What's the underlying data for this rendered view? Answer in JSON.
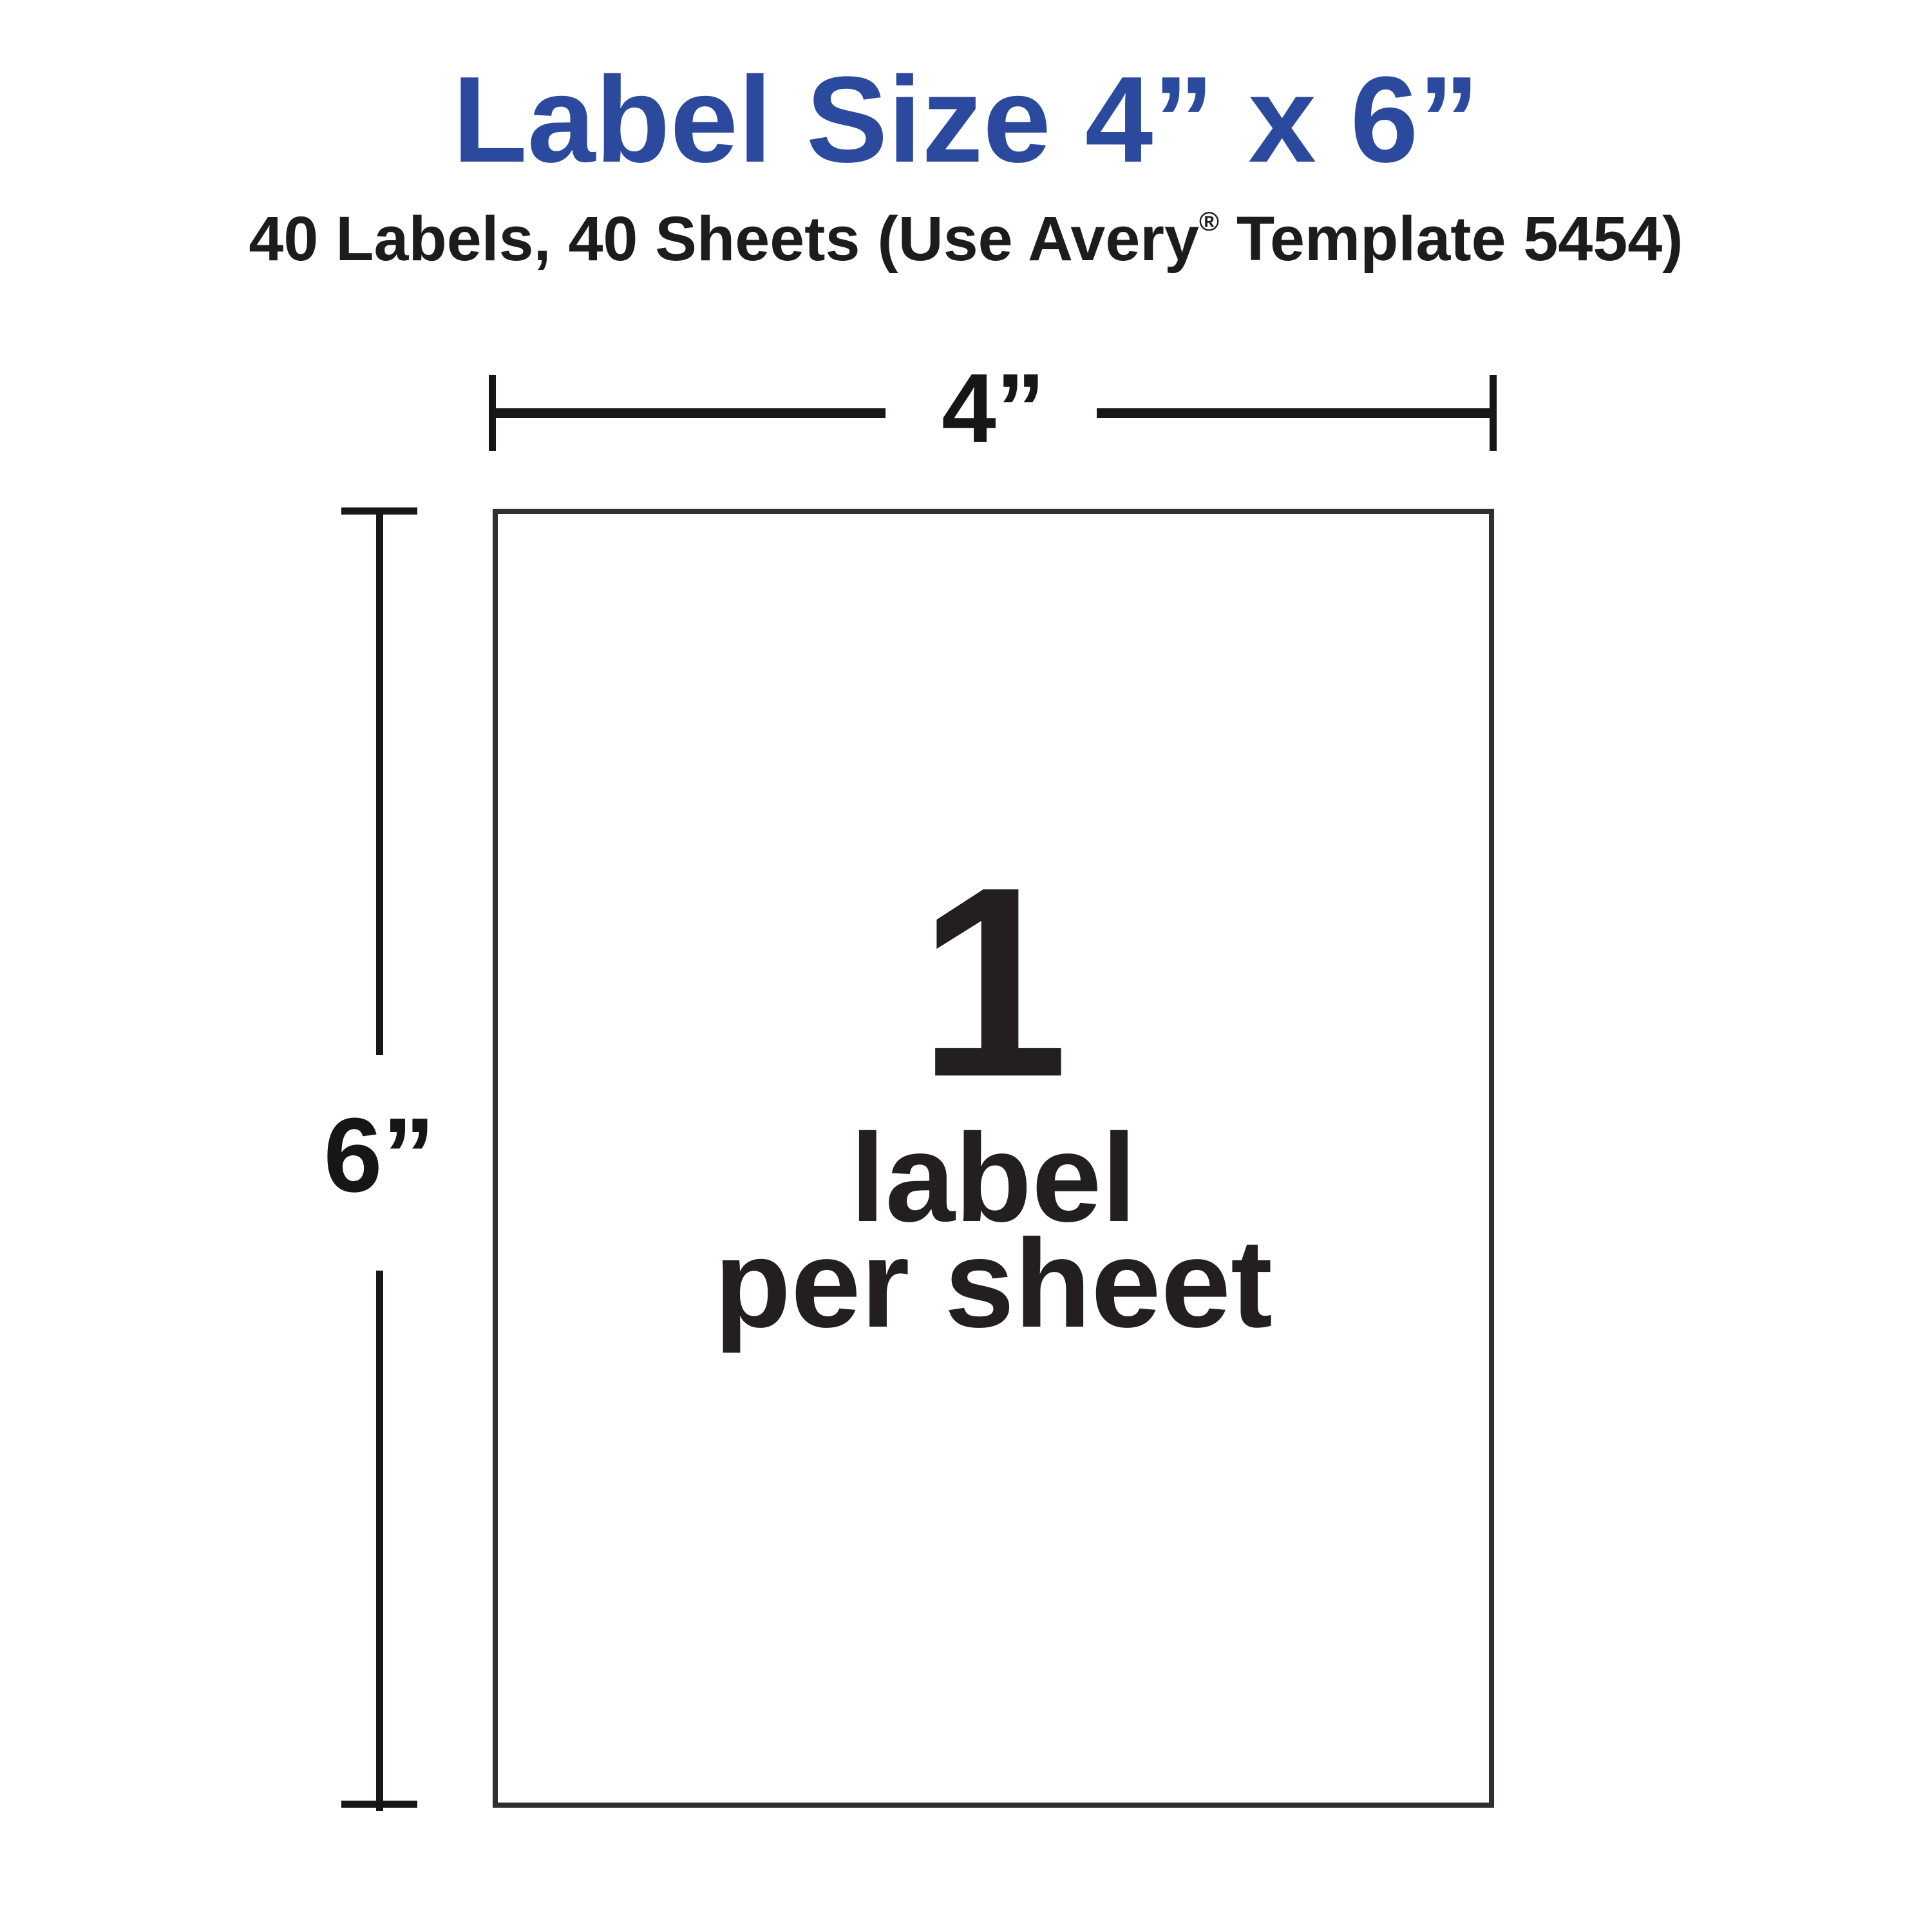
{
  "colors": {
    "background": "#ffffff",
    "title_blue": "#2b4a9e",
    "ink_black": "#231f20",
    "dimension_line": "#171516"
  },
  "header": {
    "title": "Label Size 4” x 6”",
    "subtitle": {
      "pre": "40 Labels, 40 Sheets (Use Avery",
      "sup": "®",
      "post": " Template 5454)"
    }
  },
  "diagram": {
    "width_label": "4”",
    "height_label": "6”",
    "sheet": {
      "count": "1",
      "line1": "label",
      "line2": "per sheet"
    }
  }
}
